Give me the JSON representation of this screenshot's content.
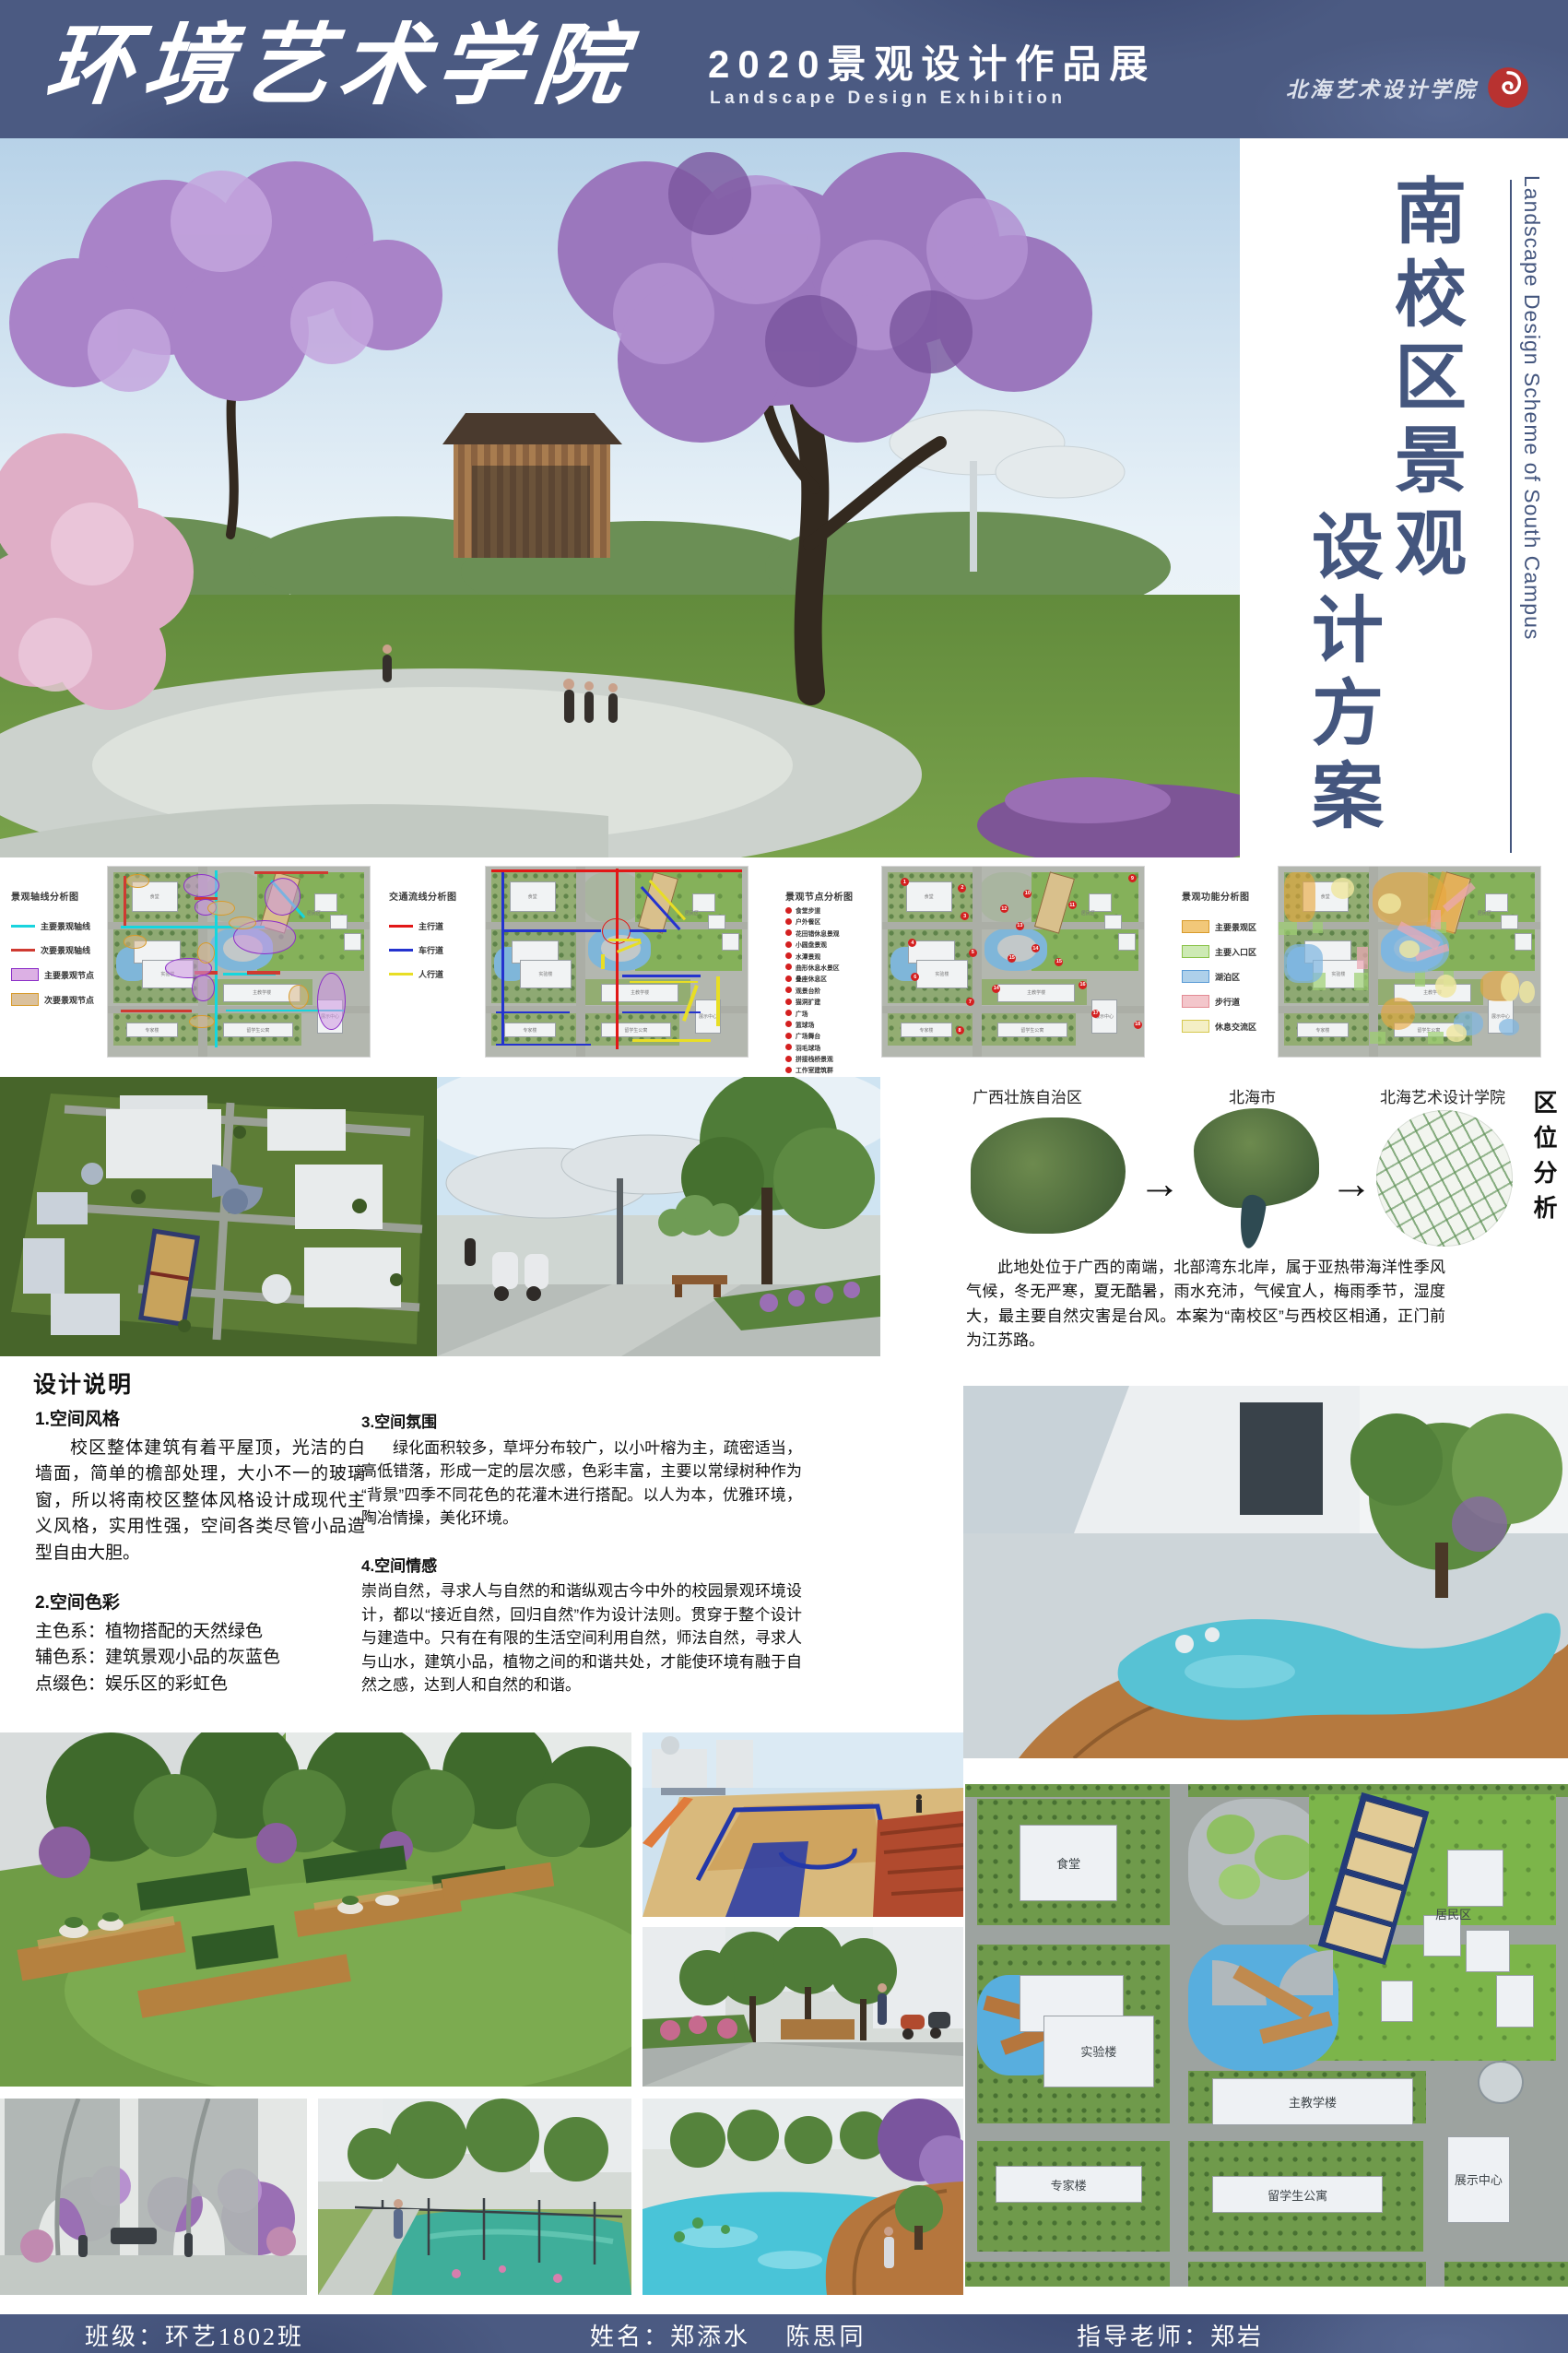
{
  "colors": {
    "bar_blue": "#4b5a82",
    "title_blue": "#44567e",
    "seal_red": "#b83230"
  },
  "icons": {
    "arrow": "→"
  },
  "header": {
    "school_title": "环境艺术学院",
    "exhibition_title": "2020景观设计作品展",
    "exhibition_subtitle": "Landscape Design Exhibition",
    "logo_text": "北海艺术设计学院"
  },
  "sidebar": {
    "title_line1": "南校区景观",
    "title_line2": "设计方案",
    "title_en": "Landscape Design Scheme of South Campus"
  },
  "diagrams": [
    {
      "title": "景观轴线分析图",
      "legend": [
        {
          "type": "line",
          "color": "#19d4de",
          "label": "主要景观轴线"
        },
        {
          "type": "line",
          "color": "#cf3a31",
          "label": "次要景观轴线"
        },
        {
          "type": "box",
          "fill": "#dcb0e4",
          "border": "#8c2fc8",
          "label": "主要景观节点"
        },
        {
          "type": "box",
          "fill": "#dbc19c",
          "border": "#d89b2b",
          "label": "次要景观节点"
        }
      ]
    },
    {
      "title": "交通流线分析图",
      "legend": [
        {
          "type": "line",
          "color": "#e21717",
          "label": "主行道"
        },
        {
          "type": "line",
          "color": "#2433cf",
          "label": "车行道"
        },
        {
          "type": "line",
          "color": "#e8de25",
          "label": "人行道"
        }
      ]
    },
    {
      "title": "景观节点分析图",
      "legend": [
        {
          "type": "dot",
          "color": "#d42020",
          "label": "食堂步道"
        },
        {
          "type": "dot",
          "color": "#d42020",
          "label": "户外餐区"
        },
        {
          "type": "dot",
          "color": "#d42020",
          "label": "花田错休息景观"
        },
        {
          "type": "dot",
          "color": "#d42020",
          "label": "小圆盘景观"
        },
        {
          "type": "dot",
          "color": "#d42020",
          "label": "水潭景观"
        },
        {
          "type": "dot",
          "color": "#d42020",
          "label": "曲形休息水景区"
        },
        {
          "type": "dot",
          "color": "#d42020",
          "label": "叠座休息区"
        },
        {
          "type": "dot",
          "color": "#d42020",
          "label": "观景台阶"
        },
        {
          "type": "dot",
          "color": "#d42020",
          "label": "猫洞扩建"
        },
        {
          "type": "dot",
          "color": "#d42020",
          "label": "广场"
        },
        {
          "type": "dot",
          "color": "#d42020",
          "label": "篮球场"
        },
        {
          "type": "dot",
          "color": "#d42020",
          "label": "广场舞台"
        },
        {
          "type": "dot",
          "color": "#d42020",
          "label": "羽毛球场"
        },
        {
          "type": "dot",
          "color": "#d42020",
          "label": "拼接栈桥景观"
        },
        {
          "type": "dot",
          "color": "#d42020",
          "label": "工作室建筑群"
        },
        {
          "type": "dot",
          "color": "#d42020",
          "label": "喷泉走道"
        },
        {
          "type": "dot",
          "color": "#d42020",
          "label": "锦绣花坛"
        },
        {
          "type": "dot",
          "color": "#d42020",
          "label": "户外T台"
        }
      ]
    },
    {
      "title": "景观功能分析图",
      "legend": [
        {
          "type": "box",
          "fill": "#f2c879",
          "border": "#d89b2b",
          "label": "主要景观区"
        },
        {
          "type": "box",
          "fill": "#cdeab4",
          "border": "#8bc34a",
          "label": "主要入口区"
        },
        {
          "type": "box",
          "fill": "#aed0ea",
          "border": "#5b9bd5",
          "label": "湖泊区"
        },
        {
          "type": "box",
          "fill": "#f3c6cb",
          "border": "#e38b94",
          "label": "步行道"
        },
        {
          "type": "box",
          "fill": "#f4efc5",
          "border": "#d6c84e",
          "label": "休息交流区"
        }
      ]
    }
  ],
  "location": {
    "section_title": "区位分析",
    "steps": [
      "广西壮族自治区",
      "北海市",
      "北海艺术设计学院"
    ],
    "description": "此地处位于广西的南端，北部湾东北岸，属于亚热带海洋性季风气候，冬无严寒，夏无酷暑，雨水充沛，气候宜人，梅雨季节，湿度大，最主要自然灾害是台风。本案为“南校区”与西校区相通，正门前为江苏路。"
  },
  "design_notes": {
    "title": "设计说明",
    "sections": [
      {
        "heading": "1.空间风格",
        "body": "校区整体建筑有着平屋顶，光洁的白墙面，简单的檐部处理，大小不一的玻璃窗，所以将南校区整体风格设计成现代主义风格，实用性强，空间各类尽管小品造型自由大胆。"
      },
      {
        "heading": "2.空间色彩",
        "body": "主色系：植物搭配的天然绿色\n辅色系：建筑景观小品的灰蓝色\n点缀色：娱乐区的彩虹色"
      },
      {
        "heading": "3.空间氛围",
        "body": "绿化面积较多，草坪分布较广，以小叶榕为主，疏密适当，高低错落，形成一定的层次感，色彩丰富，主要以常绿树种作为“背景”四季不同花色的花灌木进行搭配。以人为本，优雅环境，陶冶情操，美化环境。"
      },
      {
        "heading": "4.空间情感",
        "body": "崇尚自然，寻求人与自然的和谐纵观古今中外的校园景观环境设计，都以“接近自然，回归自然”作为设计法则。贯穿于整个设计与建造中。只有在有限的生活空间利用自然，师法自然，寻求人与山水，建筑小品，植物之间的和谐共处，才能使环境有融于自然之感，达到人和自然的和谐。"
      }
    ]
  },
  "master_plan": {
    "buildings": [
      "食堂",
      "实验楼",
      "主教学楼",
      "专家楼",
      "留学生公寓",
      "居民区",
      "展示中心"
    ]
  },
  "footer": {
    "class_label": "班级：环艺1802班",
    "name_label": "姓名：郑添水　 陈思同",
    "advisor_label": "指导老师：郑岩"
  }
}
